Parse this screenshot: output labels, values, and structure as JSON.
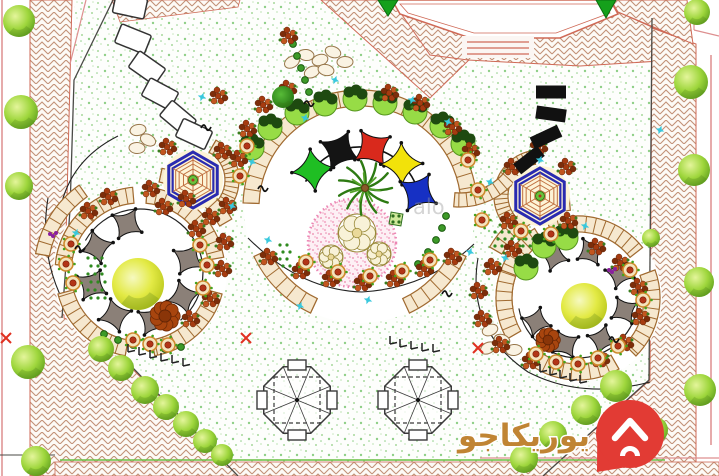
{
  "watermark": {
    "brand_text": "يوريكاجو",
    "brand_text_color": "#c08433",
    "pin_color": "#e23b34",
    "faint_text": "alo"
  },
  "palette": {
    "lawn_bg": "#fdfefc",
    "lawn_dot1": "#a8d89c",
    "lawn_dot2": "#8fcf87",
    "lawn_dot3": "#c9e8c0",
    "hatch_line": "#c29177",
    "hatch_bg": "#fdfaf6",
    "ring": "#a06a30",
    "ring_fill": "#f6e8cf",
    "pergola": "#8b8078",
    "hex_blue": "#2a2bb0",
    "web": "#c07040",
    "hex_fill": "#fdf4d6",
    "pink_bed": "#ef9ebc",
    "pink_bg": "#fdf0f5",
    "pink_edge": "#ec86b4",
    "tree_light": "#e4f59b",
    "tree_mid": "#9ed63c",
    "tree_dark": "#5d9e1d",
    "ytree_light": "#f6f9c0",
    "ytree_mid": "#e3ea45",
    "ytree_dark": "#b0bf12",
    "dtree_light": "#58bb38",
    "dtree_dark": "#1e6f10",
    "sail_green": "#1fbe23",
    "sail_black": "#141414",
    "sail_red": "#d9291c",
    "sail_yellow": "#f2e20a",
    "sail_blue": "#1630c4",
    "flower": "#a63b10",
    "flower2": "#c2561f",
    "flower3": "#7c2d0a",
    "pot_rim": "#cf8a2d",
    "pot_fill": "#f5e3bb",
    "pot_core": "#b23517",
    "sprinkler": "#38c8dd",
    "palm": "#2d7a12",
    "palm2": "#55a329",
    "boundary_pink": "#dd8f8f",
    "boundary_red": "#c0604a",
    "line_dark": "#4a4a46",
    "accent_x": "#e03020",
    "purple": "#8a1f9e",
    "corner_tree_green": "#15a01b",
    "hedge": "#3d9a28",
    "green_line": "#6abf45",
    "rock_edge": "#97764a"
  },
  "scene": {
    "nodes": {
      "center": {
        "cx": 360,
        "cy": 207,
        "r_white": 116,
        "ring_r1": 101,
        "ring_r2": 117,
        "segs": [
          [
            -178,
            -2
          ],
          [
            25,
            65
          ],
          [
            115,
            155
          ]
        ],
        "sails": {
          "r": 60,
          "size": 21,
          "angles": [
            218,
            250,
            282,
            314,
            346
          ],
          "colors": [
            "sail_green",
            "sail_black",
            "sail_red",
            "sail_yellow",
            "sail_blue"
          ],
          "arc": [
            205,
            358
          ]
        },
        "palm": [
          365,
          188
        ],
        "pink_bed": {
          "cx": 352,
          "cy": 243,
          "r": 44
        },
        "rosettes": [
          [
            357,
            233,
            19
          ],
          [
            331,
            257,
            12
          ],
          [
            379,
            254,
            12
          ]
        ],
        "green_ornament": [
          396,
          219
        ]
      },
      "left": {
        "cx": 140,
        "cy": 272,
        "r_white": 87,
        "ring_r1": 69,
        "ring_r2": 85,
        "segs": [
          [
            -170,
            -95
          ],
          [
            -85,
            -10
          ],
          [
            15,
            80
          ],
          [
            100,
            165
          ],
          [
            185,
            228
          ]
        ],
        "pergola": {
          "r": 50,
          "size": 17,
          "angles": [
            -150,
            -105,
            -15,
            30,
            75,
            120,
            165
          ]
        },
        "arc": [
          -150,
          50
        ],
        "arc_r": 63,
        "tree": [
          138,
          284,
          26
        ]
      },
      "right": {
        "cx": 578,
        "cy": 298,
        "r_white": 84,
        "ring_r1": 66,
        "ring_r2": 82,
        "segs": [
          [
            -190,
            -122
          ],
          [
            -112,
            -38
          ],
          [
            -20,
            45
          ],
          [
            60,
            130
          ],
          [
            150,
            200
          ]
        ],
        "pergola": {
          "r": 48,
          "size": 15,
          "angles": [
            -120,
            -75,
            -30,
            15,
            60,
            105,
            150
          ]
        },
        "arc": [
          -10,
          170
        ],
        "arc_r": 60,
        "tree": [
          584,
          306,
          23
        ]
      }
    },
    "extra_ladders": [
      [
        193,
        180,
        32,
        46,
        -60,
        60
      ],
      [
        540,
        196,
        32,
        46,
        120,
        262
      ],
      [
        140,
        272,
        92,
        106,
        -78,
        -30
      ],
      [
        578,
        298,
        88,
        102,
        -150,
        -95
      ],
      [
        460,
        135,
        58,
        72,
        35,
        95
      ],
      [
        140,
        272,
        92,
        106,
        190,
        235
      ]
    ],
    "hexagons": [
      [
        193,
        180
      ],
      [
        540,
        196
      ]
    ],
    "hex_r": 28,
    "octagons": [
      [
        297,
        400
      ],
      [
        418,
        400
      ]
    ],
    "oct_r": 36,
    "trees": [
      [
        19,
        21,
        16
      ],
      [
        21,
        112,
        17
      ],
      [
        19,
        186,
        14
      ],
      [
        28,
        362,
        17
      ],
      [
        36,
        461,
        15
      ],
      [
        101,
        349,
        13
      ],
      [
        121,
        368,
        13
      ],
      [
        145,
        390,
        14
      ],
      [
        166,
        407,
        13
      ],
      [
        186,
        424,
        13
      ],
      [
        205,
        441,
        12
      ],
      [
        222,
        455,
        11
      ],
      [
        616,
        386,
        16
      ],
      [
        586,
        410,
        15
      ],
      [
        553,
        435,
        14
      ],
      [
        524,
        459,
        14
      ],
      [
        697,
        12,
        13
      ],
      [
        691,
        82,
        17
      ],
      [
        694,
        170,
        16
      ],
      [
        699,
        282,
        15
      ],
      [
        700,
        390,
        16
      ],
      [
        655,
        430,
        13
      ],
      [
        651,
        238,
        9
      ]
    ],
    "dark_trees": [
      [
        283,
        97,
        11
      ]
    ],
    "rust_trees": [
      [
        165,
        316,
        16
      ],
      [
        548,
        340,
        13
      ]
    ],
    "building_triangles": [
      [
        378,
        0,
        398,
        0,
        388,
        16
      ],
      [
        596,
        0,
        616,
        0,
        606,
        18
      ]
    ],
    "stones_white": [
      [
        130,
        6,
        12
      ],
      [
        133,
        39,
        22
      ],
      [
        147,
        68,
        35
      ],
      [
        160,
        94,
        28
      ],
      [
        178,
        118,
        40
      ],
      [
        194,
        134,
        25
      ]
    ],
    "stones_black": [
      [
        551,
        92,
        0
      ],
      [
        551,
        114,
        8
      ],
      [
        546,
        137,
        -25
      ],
      [
        529,
        160,
        -38
      ]
    ],
    "sprinklers": [
      [
        335,
        80
      ],
      [
        305,
        118
      ],
      [
        252,
        162
      ],
      [
        232,
        206
      ],
      [
        268,
        240
      ],
      [
        412,
        100
      ],
      [
        448,
        122
      ],
      [
        490,
        182
      ],
      [
        470,
        252
      ],
      [
        300,
        306
      ],
      [
        368,
        300
      ],
      [
        505,
        258
      ],
      [
        585,
        226
      ],
      [
        660,
        130
      ],
      [
        76,
        233
      ],
      [
        202,
        97
      ],
      [
        540,
        160
      ]
    ],
    "flowers": [
      [
        88,
        212
      ],
      [
        108,
        198
      ],
      [
        150,
        190
      ],
      [
        186,
        200
      ],
      [
        210,
        218
      ],
      [
        224,
        243
      ],
      [
        222,
        270
      ],
      [
        210,
        300
      ],
      [
        190,
        320
      ],
      [
        167,
        148
      ],
      [
        222,
        152
      ],
      [
        163,
        208
      ],
      [
        227,
        207
      ],
      [
        196,
        230
      ],
      [
        263,
        106
      ],
      [
        287,
        90
      ],
      [
        389,
        94
      ],
      [
        420,
        104
      ],
      [
        452,
        128
      ],
      [
        470,
        152
      ],
      [
        247,
        130
      ],
      [
        238,
        160
      ],
      [
        300,
        272
      ],
      [
        330,
        280
      ],
      [
        362,
        284
      ],
      [
        394,
        280
      ],
      [
        424,
        270
      ],
      [
        268,
        258
      ],
      [
        452,
        258
      ],
      [
        512,
        168
      ],
      [
        566,
        168
      ],
      [
        508,
        222
      ],
      [
        568,
        222
      ],
      [
        596,
        248
      ],
      [
        620,
        264
      ],
      [
        638,
        288
      ],
      [
        640,
        318
      ],
      [
        624,
        344
      ],
      [
        600,
        360
      ],
      [
        512,
        250
      ],
      [
        492,
        268
      ],
      [
        478,
        292
      ],
      [
        482,
        320
      ],
      [
        500,
        346
      ],
      [
        530,
        362
      ],
      [
        288,
        37
      ],
      [
        218,
        97
      ],
      [
        538,
        148
      ]
    ],
    "pots": [
      [
        71,
        244
      ],
      [
        66,
        264
      ],
      [
        73,
        283
      ],
      [
        200,
        245
      ],
      [
        207,
        265
      ],
      [
        203,
        288
      ],
      [
        133,
        340
      ],
      [
        150,
        344
      ],
      [
        168,
        345
      ],
      [
        247,
        146
      ],
      [
        240,
        176
      ],
      [
        468,
        160
      ],
      [
        478,
        190
      ],
      [
        482,
        220
      ],
      [
        306,
        262
      ],
      [
        338,
        272
      ],
      [
        370,
        276
      ],
      [
        402,
        271
      ],
      [
        430,
        260
      ],
      [
        521,
        231
      ],
      [
        551,
        234
      ],
      [
        536,
        354
      ],
      [
        556,
        362
      ],
      [
        578,
        364
      ],
      [
        598,
        358
      ],
      [
        618,
        346
      ],
      [
        630,
        270
      ],
      [
        643,
        300
      ]
    ],
    "shrubs": [
      [
        297,
        113
      ],
      [
        325,
        104
      ],
      [
        355,
        99
      ],
      [
        385,
        103
      ],
      [
        415,
        112
      ],
      [
        442,
        126
      ],
      [
        463,
        144
      ],
      [
        270,
        128
      ],
      [
        252,
        148
      ],
      [
        526,
        268
      ],
      [
        544,
        246
      ],
      [
        566,
        238
      ]
    ],
    "hedge_dots": [
      [
        293,
        44
      ],
      [
        297,
        56
      ],
      [
        301,
        68
      ],
      [
        305,
        80
      ],
      [
        309,
        92
      ],
      [
        104,
        334
      ],
      [
        118,
        340
      ],
      [
        133,
        345
      ],
      [
        149,
        348
      ],
      [
        165,
        349
      ],
      [
        181,
        347
      ],
      [
        418,
        264
      ],
      [
        428,
        252
      ],
      [
        436,
        240
      ],
      [
        442,
        228
      ],
      [
        446,
        216
      ]
    ],
    "dot_grids": [
      [
        495,
        232,
        6,
        3,
        7,
        7
      ],
      [
        88,
        258,
        3,
        6,
        7,
        8
      ],
      [
        280,
        245,
        2,
        4,
        7,
        7
      ]
    ],
    "rocks": [
      [
        292,
        62
      ],
      [
        306,
        55
      ],
      [
        320,
        60
      ],
      [
        333,
        52
      ],
      [
        345,
        62
      ],
      [
        312,
        72
      ],
      [
        326,
        70
      ],
      [
        138,
        130
      ],
      [
        148,
        140
      ],
      [
        137,
        148
      ],
      [
        490,
        330
      ],
      [
        502,
        340
      ],
      [
        514,
        350
      ],
      [
        488,
        348
      ]
    ],
    "ticks": [
      [
        128,
        352
      ],
      [
        139,
        355
      ],
      [
        150,
        358
      ],
      [
        161,
        361
      ],
      [
        172,
        363
      ],
      [
        183,
        366
      ],
      [
        390,
        344
      ],
      [
        400,
        347
      ],
      [
        411,
        349
      ],
      [
        422,
        351
      ],
      [
        433,
        352
      ],
      [
        540,
        372
      ],
      [
        550,
        375
      ],
      [
        560,
        378
      ],
      [
        570,
        381
      ],
      [
        580,
        383
      ]
    ],
    "xmarks": [
      [
        246,
        338
      ],
      [
        478,
        348
      ],
      [
        6,
        338
      ]
    ],
    "birds": [
      [
        206,
        126
      ],
      [
        263,
        187
      ],
      [
        309,
        102
      ],
      [
        80,
        247
      ],
      [
        447,
        292
      ],
      [
        614,
        338
      ]
    ],
    "purples": [
      [
        53,
        236
      ],
      [
        612,
        272
      ]
    ]
  }
}
